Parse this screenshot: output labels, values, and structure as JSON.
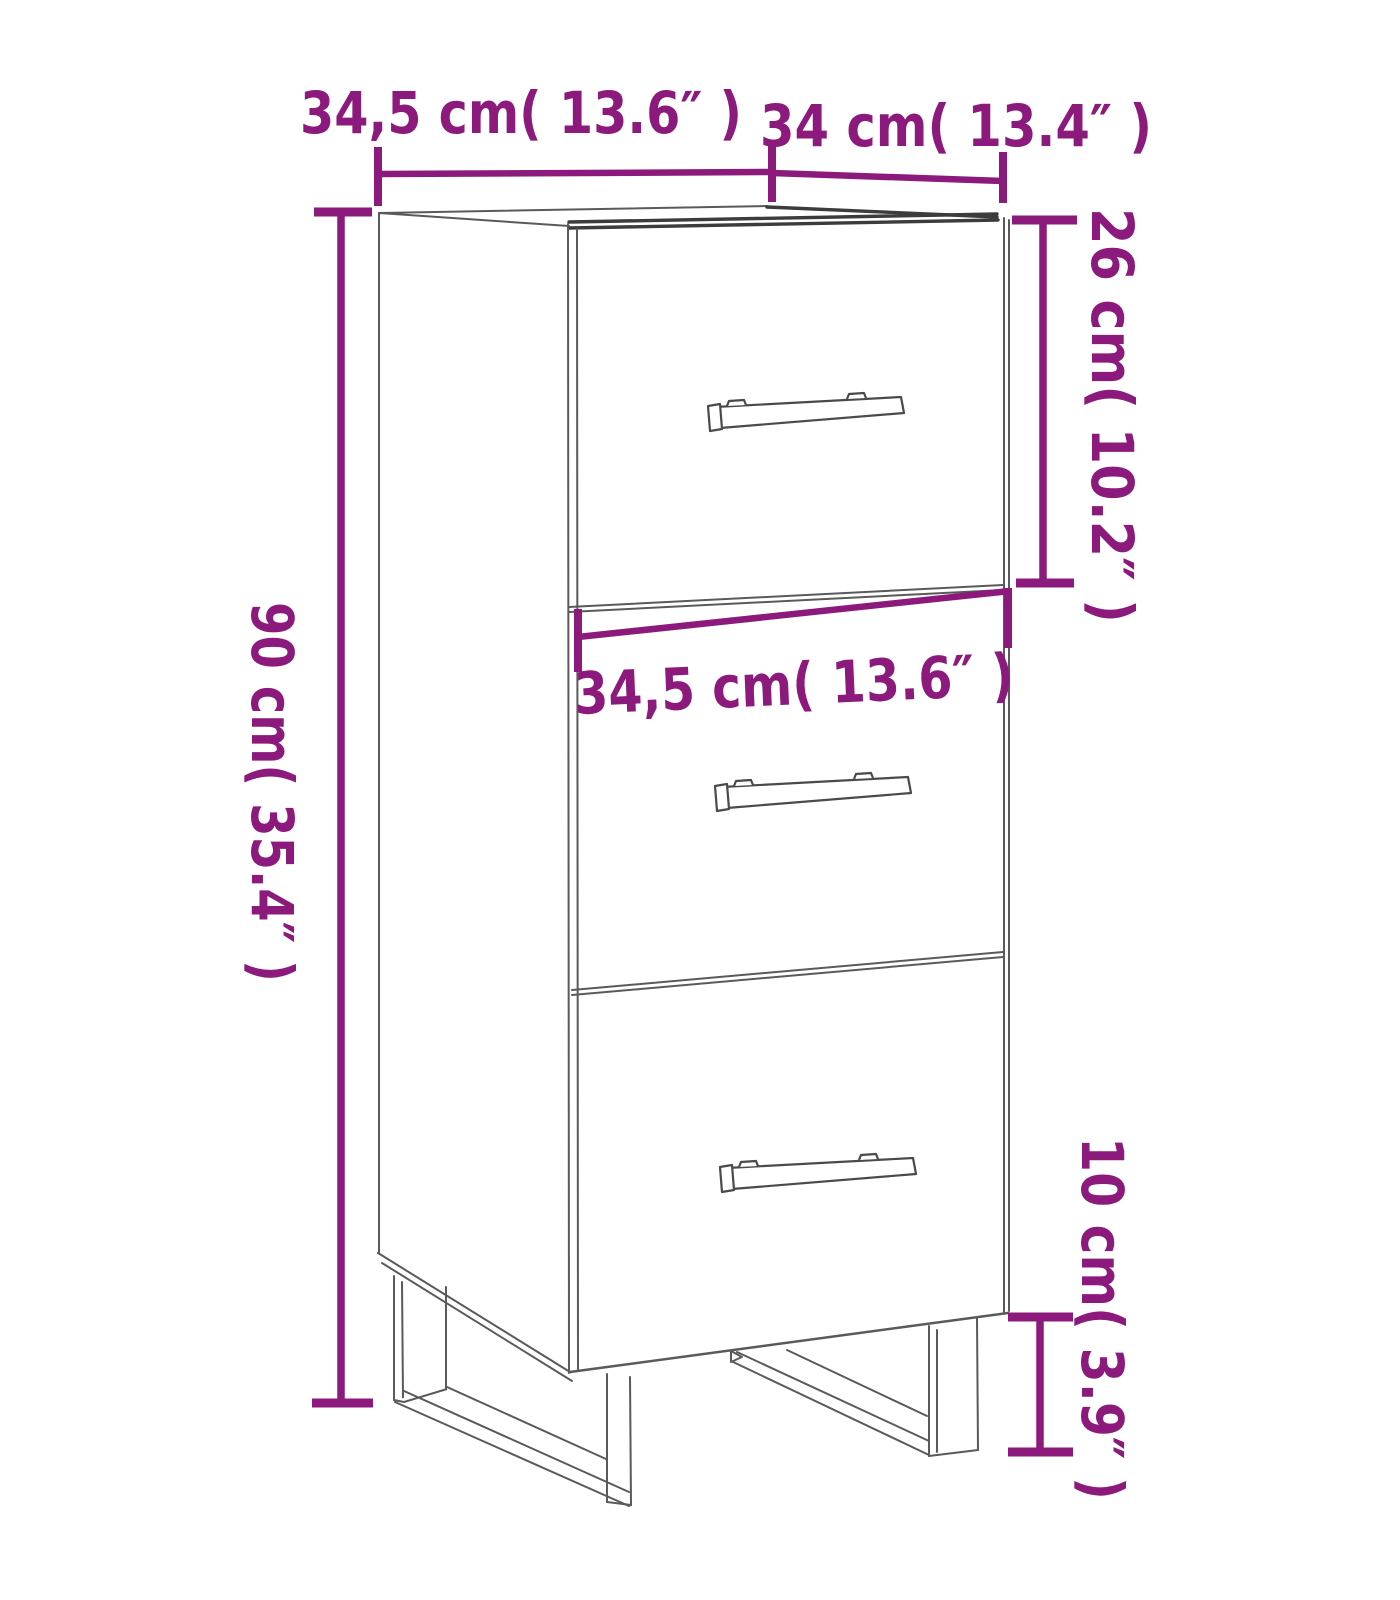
{
  "diagram": {
    "title": "sideboard-3-drawers-dimension-diagram",
    "labels": {
      "top_width": "34,5 cm( 13.6″ )",
      "top_depth": "34 cm( 13.4″ )",
      "right_drawer_height": "26 cm( 10.2″ )",
      "left_total_height": "90 cm( 35.4″ )",
      "middle_width": "34,5 cm( 13.6″ )",
      "right_leg_height": "10 cm( 3.9″ )"
    },
    "colors": {
      "dimension": "#8b1a7c",
      "outline_thin": "#5a5a5a",
      "outline_thick": "#3c3c3c",
      "background": "#ffffff"
    }
  }
}
